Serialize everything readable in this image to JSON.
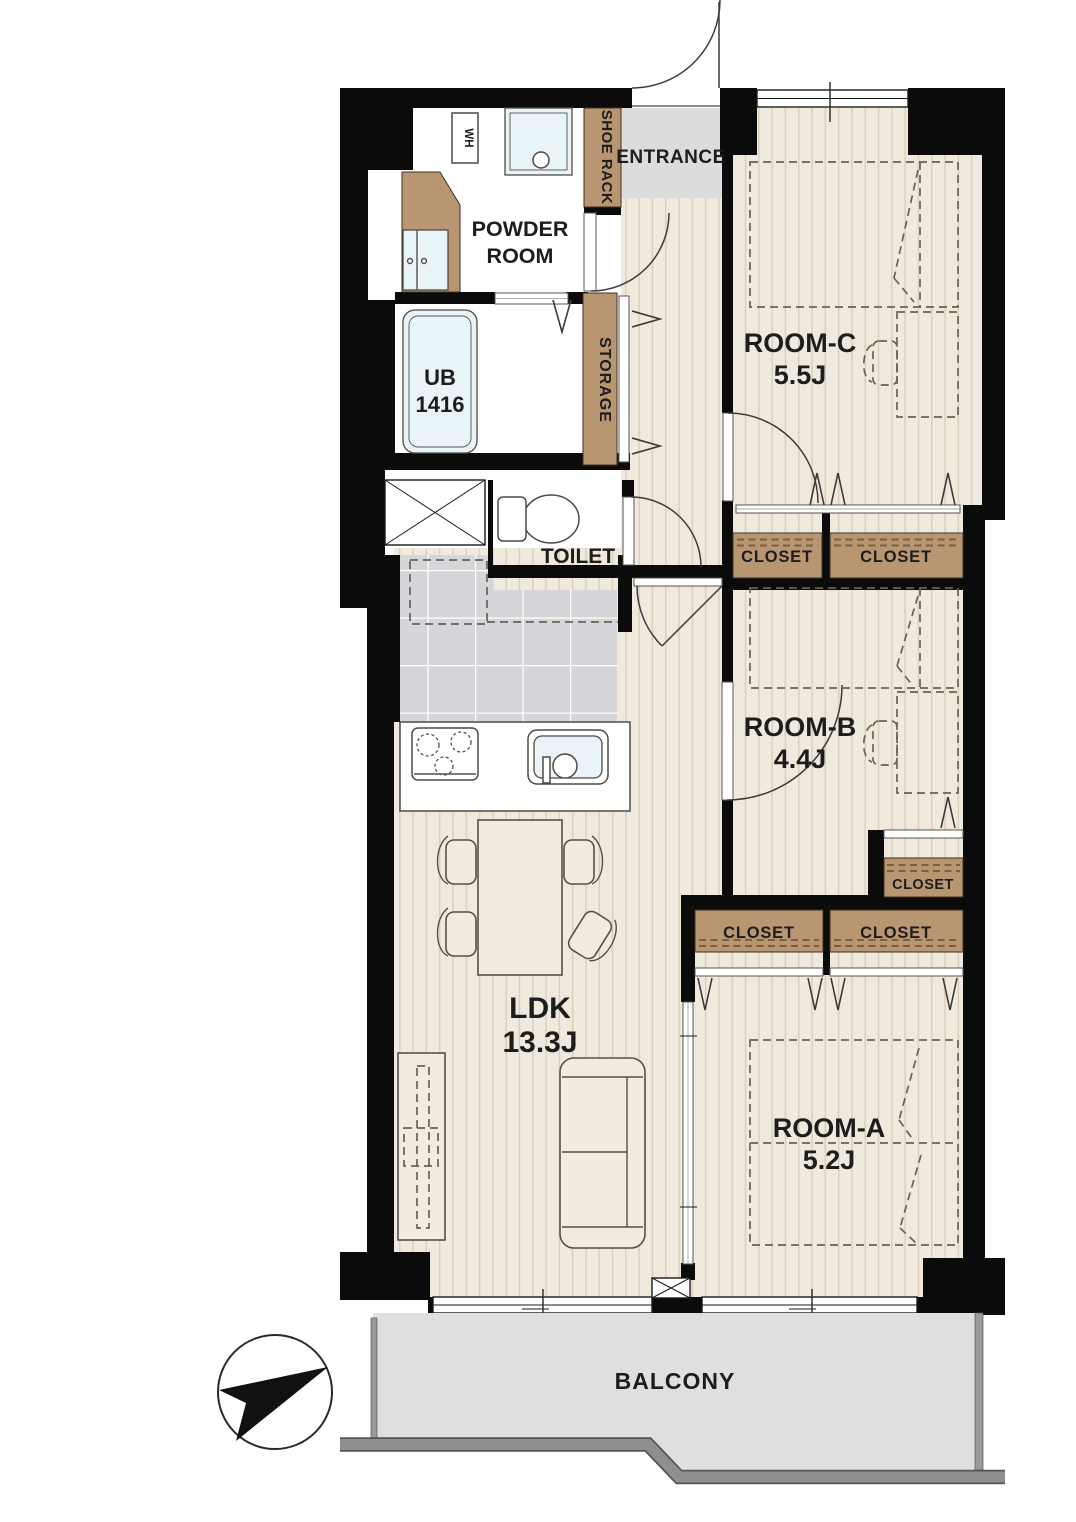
{
  "floor_plan": {
    "entrance": "ENTRANCE",
    "powder_room": {
      "line1": "POWDER",
      "line2": "ROOM"
    },
    "water_heater": "WH",
    "shoe_rack": "SHOE RACK",
    "storage": "STORAGE",
    "unit_bath": {
      "line1": "UB",
      "line2": "1416"
    },
    "toilet": "TOILET",
    "closet": "CLOSET",
    "balcony": "BALCONY",
    "rooms": {
      "room_c": {
        "name": "ROOM-C",
        "size": "5.5J"
      },
      "room_b": {
        "name": "ROOM-B",
        "size": "4.4J"
      },
      "room_a": {
        "name": "ROOM-A",
        "size": "5.2J"
      },
      "ldk": {
        "name": "LDK",
        "size": "13.3J"
      }
    },
    "compass": {
      "arrow_points": "upper-right"
    },
    "colors": {
      "wall": "#0b0b0b",
      "floor": "#f0e9dd",
      "floor_stripe": "#dccfbd",
      "wood_accent": "#b99672",
      "kitchen_tile": "#d6d6da",
      "entrance_floor": "#dcdcdf",
      "balcony_floor": "#dfdfe2",
      "railing": "#8f8f8f",
      "water_fixture": "#e9f4f8",
      "label_text": "#1d1d1d"
    }
  }
}
